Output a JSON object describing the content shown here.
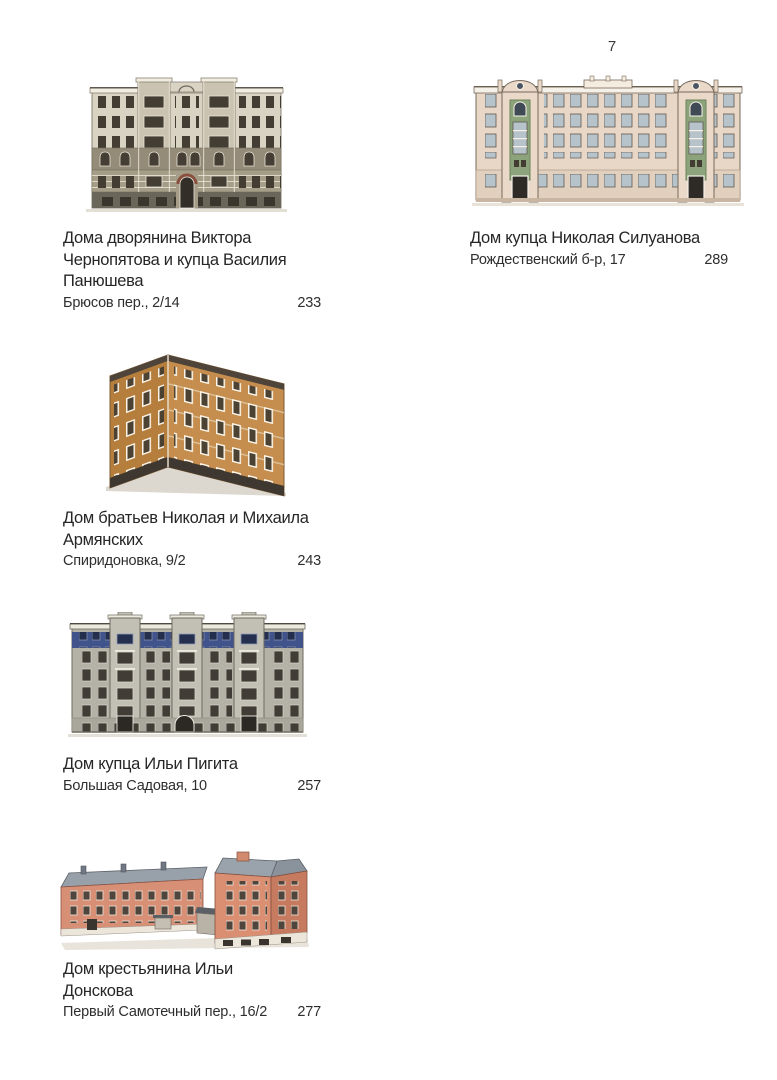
{
  "page": {
    "number": "7"
  },
  "colors": {
    "background": "#ffffff",
    "text": "#262626",
    "building1_facade": "#d9d3c4",
    "building2_facade": "#e8d7c7",
    "building2_green_accent": "#8da37b",
    "building3_facade": "#c68e4e",
    "building4_facade": "#b4b2a7",
    "building4_blue_frieze": "#40538a",
    "building5_facade": "#d78f76",
    "building5_roof": "#98a1a9"
  },
  "entries": [
    {
      "title": "Дома дворянина Виктора Чернопятова и купца Василия Панюшева",
      "address": "Брюсов пер., 2/14",
      "page_ref": "233",
      "illustration": "six-story-gray-apartment-house-facade"
    },
    {
      "title": "Дом купца Николая Силуанова",
      "address": "Рождественский б-р, 17",
      "page_ref": "289",
      "illustration": "long-five-story-house-with-two-green-towers"
    },
    {
      "title": "Дом братьев Николая и Михаила Армянских",
      "address": "Спиридоновка, 9/2",
      "page_ref": "243",
      "illustration": "corner-ochre-apartment-house-perspective"
    },
    {
      "title": "Дом купца Ильи Пигита",
      "address": "Большая Садовая, 10",
      "page_ref": "257",
      "illustration": "wide-gray-facade-with-blue-frieze-and-three-bays"
    },
    {
      "title": "Дом крестьянина Ильи Донскова",
      "address": "Первый Самотечный пер., 16/2",
      "page_ref": "277",
      "illustration": "l-shaped-salmon-brick-courtyard-building"
    }
  ]
}
